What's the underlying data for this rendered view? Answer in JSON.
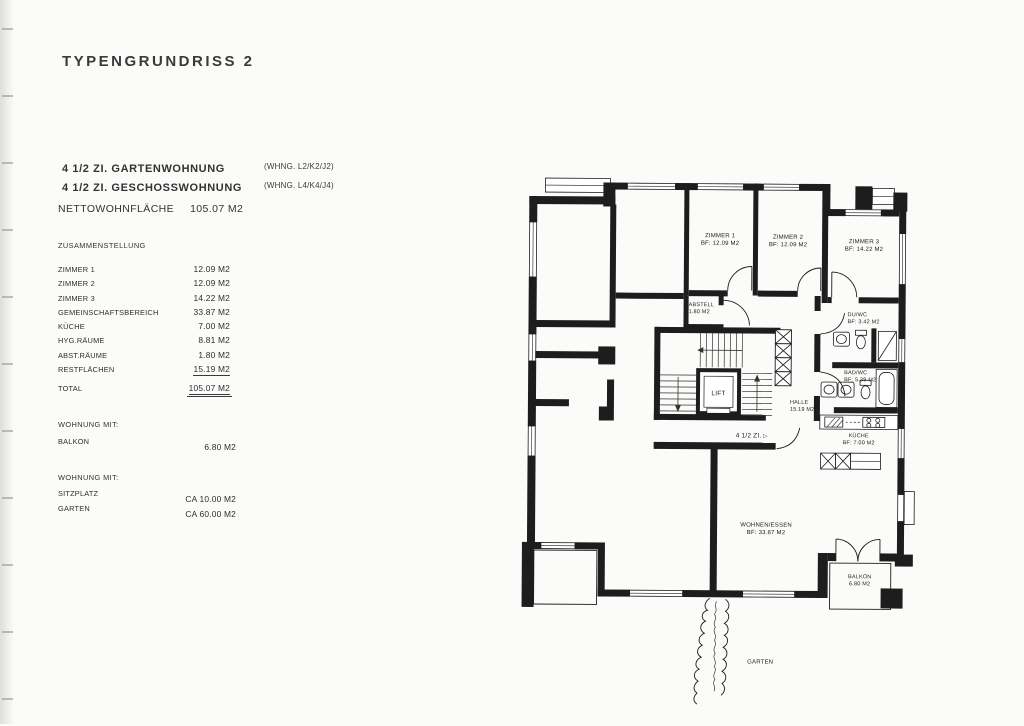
{
  "document": {
    "title": "TYPENGRUNDRISS 2"
  },
  "apartment_types": [
    {
      "label": "4 1/2 ZI. GARTENWOHNUNG",
      "unit_ref": "(WHNG. L2/K2/J2)"
    },
    {
      "label": "4 1/2 ZI. GESCHOSSWOHNUNG",
      "unit_ref": "(WHNG. L4/K4/J4)"
    }
  ],
  "net_area": {
    "label": "NETTOWOHNFLÄCHE",
    "value": "105.07 M2"
  },
  "summary": {
    "title": "ZUSAMMENSTELLUNG",
    "rows": [
      {
        "label": "ZIMMER 1",
        "value": "12.09 M2"
      },
      {
        "label": "ZIMMER 2",
        "value": "12.09 M2"
      },
      {
        "label": "ZIMMER 3",
        "value": "14.22 M2"
      },
      {
        "label": "GEMEINSCHAFTSBEREICH",
        "value": "33.87 M2"
      },
      {
        "label": "KÜCHE",
        "value": "7.00 M2"
      },
      {
        "label": "HYG.RÄUME",
        "value": "8.81 M2"
      },
      {
        "label": "ABST.RÄUME",
        "value": "1.80 M2"
      },
      {
        "label": "RESTFLÄCHEN",
        "value": "15.19 M2"
      }
    ],
    "total": {
      "label": "TOTAL",
      "value": "105.07 M2"
    }
  },
  "extras": [
    {
      "title": "WOHNUNG MIT:",
      "rows": [
        {
          "label": "BALKON",
          "value": "6.80 M2"
        }
      ]
    },
    {
      "title": "WOHNUNG MIT:",
      "rows": [
        {
          "label": "SITZPLATZ",
          "value": "CA 10.00 M2"
        },
        {
          "label": "GARTEN",
          "value": "CA 60.00 M2"
        }
      ]
    }
  ],
  "floorplan": {
    "zimmer1": {
      "name": "ZIMMER 1",
      "area": "BF: 12.09 M2"
    },
    "zimmer2": {
      "name": "ZIMMER 2",
      "area": "BF: 12.09 M2"
    },
    "zimmer3": {
      "name": "ZIMMER 3",
      "area": "BF: 14.22 M2"
    },
    "abstell": {
      "name": "ABSTELL",
      "area": "1.80 M2"
    },
    "du_wc": {
      "name": "DU/WC",
      "area": "BF: 3.42 M2"
    },
    "bad_wc": {
      "name": "BAD/WC",
      "area": "BF: 5.39 M2"
    },
    "kueche": {
      "name": "KÜCHE",
      "area": "BF: 7.00 M2"
    },
    "halle": {
      "name": "HALLE",
      "area": "15.19 M2"
    },
    "lift": {
      "name": "LIFT"
    },
    "wohnen": {
      "name": "WOHNEN/ESSEN",
      "area": "BF: 33.87 M2"
    },
    "balkon": {
      "name": "BALKON",
      "area": "6.80 M2"
    },
    "garten": {
      "name": "GARTEN"
    },
    "unit_label": "4 1/2 ZI.",
    "unit_arrow": "▷"
  },
  "colors": {
    "ink": "#1d1d1d",
    "paper": "#fbfbf9"
  }
}
